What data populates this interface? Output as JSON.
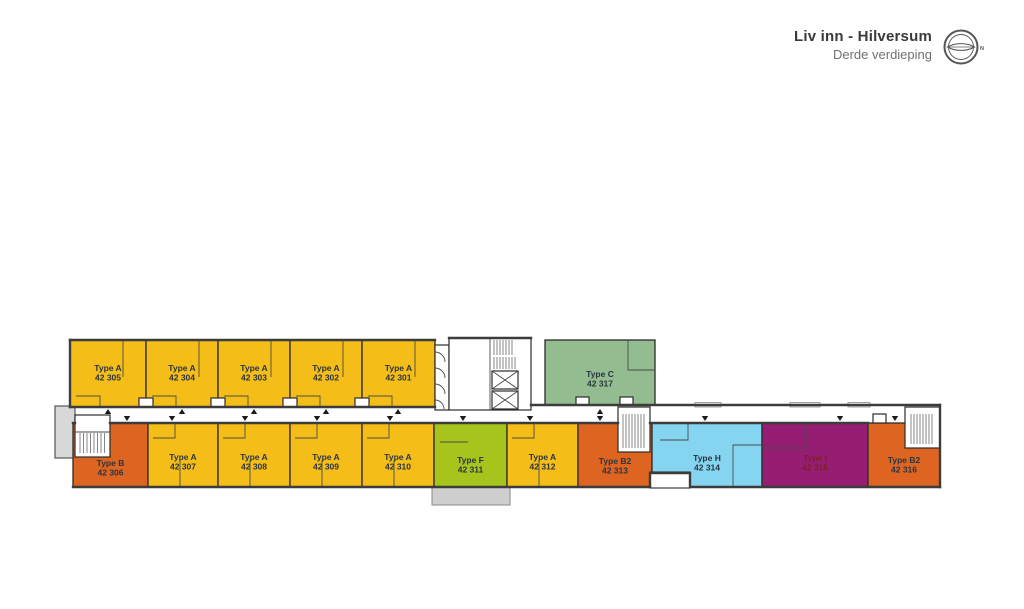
{
  "header": {
    "project_title": "Liv inn - Hilversum",
    "floor_subtitle": "Derde verdieping",
    "compass_label": "N"
  },
  "colors": {
    "type_a": "#F5BD17",
    "type_b": "#DD6521",
    "type_b2": "#DD6521",
    "type_c": "#93BC91",
    "type_f": "#A7C41D",
    "type_h": "#85D4F0",
    "type_i": "#951D72",
    "label": "#2A3540",
    "label_on_type_i": "#7D1F24",
    "wall": "#3C3C3C",
    "terrace": "#CFCFCF",
    "stair_block": "#D8D8D8"
  },
  "units": [
    {
      "type_label": "Type A",
      "number": "42 305",
      "color_key": "type_a",
      "x": 70,
      "y": 340,
      "w": 76,
      "h": 67,
      "entrance": "top",
      "tx": 108,
      "label_y": 371
    },
    {
      "type_label": "Type A",
      "number": "42 304",
      "color_key": "type_a",
      "x": 146,
      "y": 340,
      "w": 72,
      "h": 67,
      "entrance": "top",
      "tx": 182,
      "label_y": 371
    },
    {
      "type_label": "Type A",
      "number": "42 303",
      "color_key": "type_a",
      "x": 218,
      "y": 340,
      "w": 72,
      "h": 67,
      "entrance": "top",
      "tx": 254,
      "label_y": 371
    },
    {
      "type_label": "Type A",
      "number": "42 302",
      "color_key": "type_a",
      "x": 290,
      "y": 340,
      "w": 72,
      "h": 67,
      "entrance": "top",
      "tx": 326,
      "label_y": 371
    },
    {
      "type_label": "Type A",
      "number": "42 301",
      "color_key": "type_a",
      "x": 362,
      "y": 340,
      "w": 73,
      "h": 67,
      "entrance": "top",
      "tx": 398,
      "label_y": 371
    },
    {
      "type_label": "Type C",
      "number": "42 317",
      "color_key": "type_c",
      "x": 545,
      "y": 340,
      "w": 110,
      "h": 65,
      "entrance": "top",
      "tx": 600,
      "label_y": 377
    },
    {
      "type_label": "Type B",
      "number": "42 306",
      "color_key": "type_b",
      "x": 73,
      "y": 423,
      "w": 75,
      "h": 64,
      "entrance": "bottom",
      "tx": 127,
      "label_y": 466
    },
    {
      "type_label": "Type A",
      "number": "42 307",
      "color_key": "type_a",
      "x": 148,
      "y": 423,
      "w": 70,
      "h": 64,
      "entrance": "bottom",
      "tx": 172,
      "label_y": 460
    },
    {
      "type_label": "Type A",
      "number": "42 308",
      "color_key": "type_a",
      "x": 218,
      "y": 423,
      "w": 72,
      "h": 64,
      "entrance": "bottom",
      "tx": 245,
      "label_y": 460
    },
    {
      "type_label": "Type A",
      "number": "42 309",
      "color_key": "type_a",
      "x": 290,
      "y": 423,
      "w": 72,
      "h": 64,
      "entrance": "bottom",
      "tx": 317,
      "label_y": 460
    },
    {
      "type_label": "Type A",
      "number": "42 310",
      "color_key": "type_a",
      "x": 362,
      "y": 423,
      "w": 72,
      "h": 64,
      "entrance": "bottom",
      "tx": 390,
      "label_y": 460
    },
    {
      "type_label": "Type F",
      "number": "42 311",
      "color_key": "type_f",
      "x": 434,
      "y": 423,
      "w": 73,
      "h": 64,
      "entrance": "bottom",
      "tx": 463,
      "label_y": 463
    },
    {
      "type_label": "Type A",
      "number": "42 312",
      "color_key": "type_a",
      "x": 507,
      "y": 423,
      "w": 71,
      "h": 64,
      "entrance": "bottom",
      "tx": 530,
      "label_y": 460
    },
    {
      "type_label": "Type B2",
      "number": "42 313",
      "color_key": "type_b2",
      "x": 578,
      "y": 423,
      "w": 74,
      "h": 64,
      "entrance": "bottom",
      "tx": 600,
      "label_y": 464
    },
    {
      "type_label": "Type H",
      "number": "42 314",
      "color_key": "type_h",
      "x": 652,
      "y": 423,
      "w": 110,
      "h": 64,
      "entrance": "bottom",
      "tx": 705,
      "label_y": 461
    },
    {
      "type_label": "Type I",
      "number": "42 315",
      "color_key": "type_i",
      "x": 762,
      "y": 423,
      "w": 106,
      "h": 64,
      "entrance": "bottom",
      "tx": 840,
      "label_y": 461,
      "label_color_key": "label_on_type_i"
    },
    {
      "type_label": "Type B2",
      "number": "42 316",
      "color_key": "type_b2",
      "x": 868,
      "y": 423,
      "w": 72,
      "h": 64,
      "entrance": "bottom",
      "tx": 895,
      "label_y": 463
    }
  ]
}
